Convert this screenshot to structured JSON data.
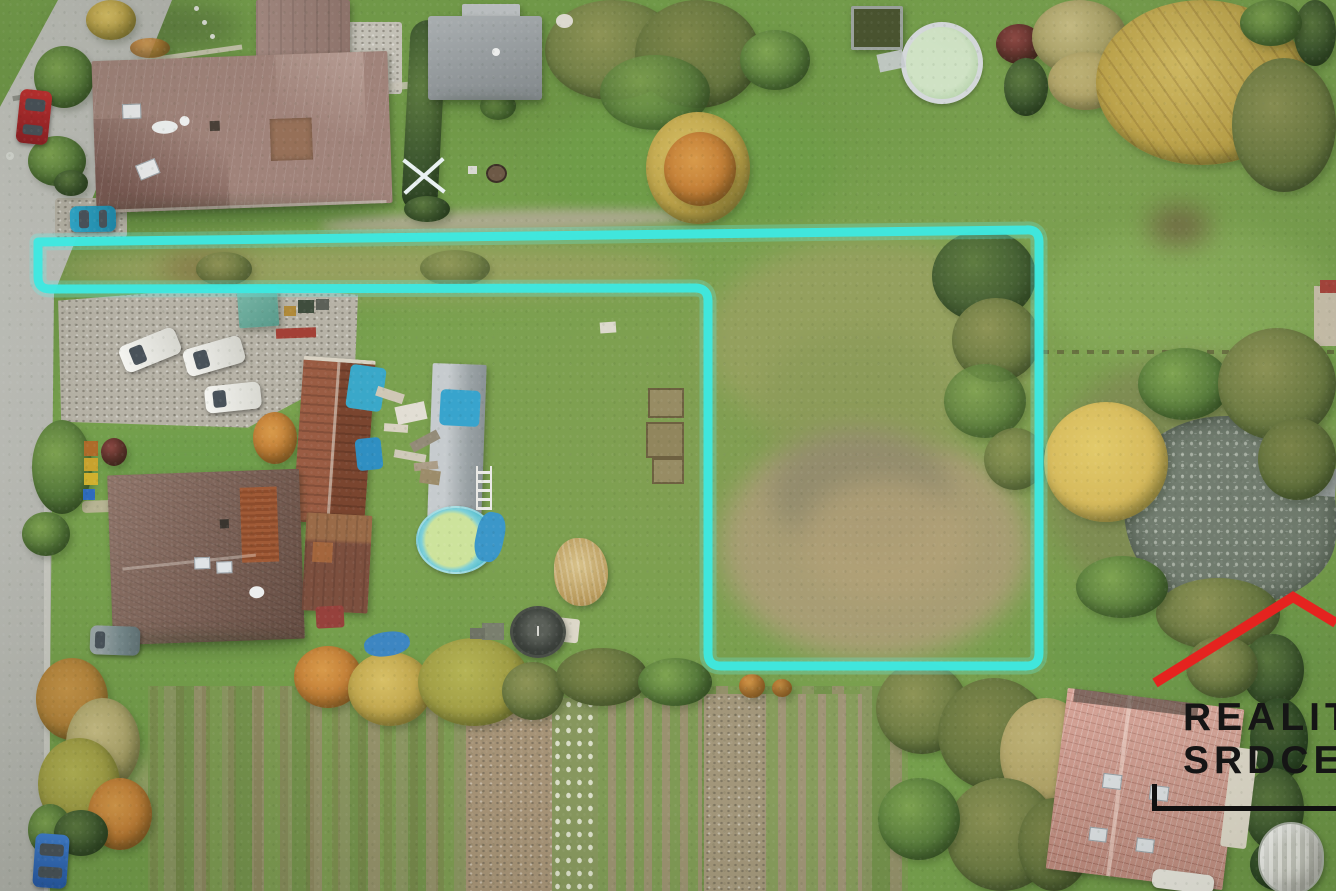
{
  "image_type": "aerial-drone-photo",
  "scene": {
    "boundary": {
      "color": "#3de9e1",
      "path": "M 38 242 L 690 234 L 1026 230 Q 1039 229 1039 242 L 1039 653 Q 1039 666 1026 666 L 721 666 Q 708 666 708 653 L 708 301 Q 708 288 695 288 L 50 289 Q 38 289 38 277 Z"
    },
    "watermark": {
      "line1": "REALI",
      "line1_fragment": "T",
      "line2": "SRDCE",
      "roof_points": "1155,683 1293,597 1336,623",
      "roof_color": "#e5231f",
      "text_color": "#151515"
    }
  }
}
